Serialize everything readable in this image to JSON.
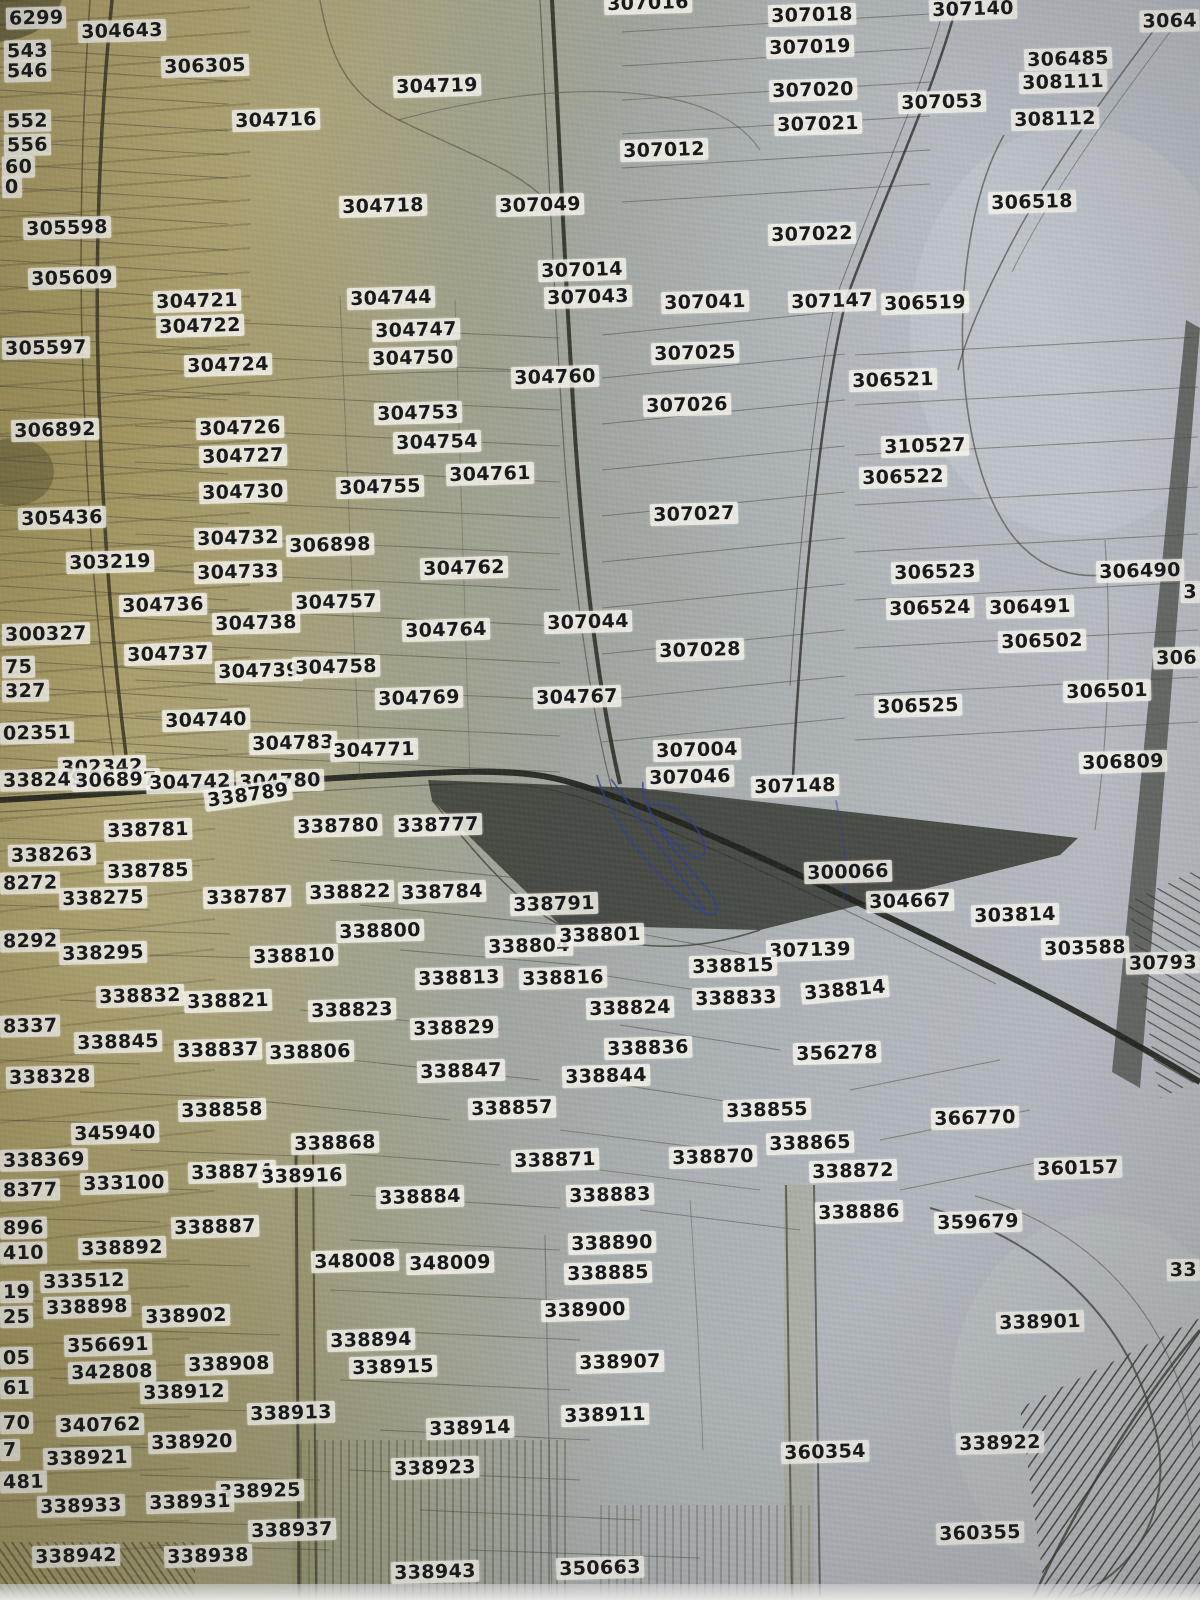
{
  "title": "cadastral-parcel-map-photo",
  "palette": {
    "map_tan": "#b0a471",
    "map_gray": "#b7bcc2",
    "label_bg": "#f4f1e8",
    "label_text": "#17181a",
    "dark_parcel": "#41453d",
    "road_dark": "#1f221c",
    "ink_blue": "#2f3f9a"
  },
  "parcels": [
    {
      "t": "6299",
      "x": 6,
      "y": 18,
      "a": "l"
    },
    {
      "t": "304643",
      "x": 122,
      "y": 31
    },
    {
      "t": "307016",
      "x": 648,
      "y": 3
    },
    {
      "t": "307018",
      "x": 812,
      "y": 15
    },
    {
      "t": "307140",
      "x": 973,
      "y": 9
    },
    {
      "t": "3064",
      "x": 1200,
      "y": 21,
      "a": "r"
    },
    {
      "t": "543",
      "x": 4,
      "y": 51,
      "a": "l"
    },
    {
      "t": "546",
      "x": 4,
      "y": 71,
      "a": "l"
    },
    {
      "t": "306305",
      "x": 205,
      "y": 66
    },
    {
      "t": "304719",
      "x": 437,
      "y": 86
    },
    {
      "t": "307019",
      "x": 810,
      "y": 47
    },
    {
      "t": "306485",
      "x": 1068,
      "y": 59
    },
    {
      "t": "308111",
      "x": 1063,
      "y": 82
    },
    {
      "t": "304716",
      "x": 276,
      "y": 120
    },
    {
      "t": "307020",
      "x": 813,
      "y": 90
    },
    {
      "t": "307053",
      "x": 942,
      "y": 102
    },
    {
      "t": "308112",
      "x": 1055,
      "y": 119
    },
    {
      "t": "307021",
      "x": 818,
      "y": 124
    },
    {
      "t": "552",
      "x": 4,
      "y": 121,
      "a": "l"
    },
    {
      "t": "556",
      "x": 4,
      "y": 145,
      "a": "l"
    },
    {
      "t": "307012",
      "x": 664,
      "y": 150
    },
    {
      "t": "60",
      "x": 2,
      "y": 167,
      "a": "l"
    },
    {
      "t": "0",
      "x": 2,
      "y": 187,
      "a": "l"
    },
    {
      "t": "304718",
      "x": 383,
      "y": 206
    },
    {
      "t": "307049",
      "x": 540,
      "y": 205
    },
    {
      "t": "306518",
      "x": 1032,
      "y": 202
    },
    {
      "t": "305598",
      "x": 67,
      "y": 228
    },
    {
      "t": "307022",
      "x": 812,
      "y": 234
    },
    {
      "t": "305609",
      "x": 72,
      "y": 278
    },
    {
      "t": "307014",
      "x": 582,
      "y": 270
    },
    {
      "t": "307043",
      "x": 588,
      "y": 297
    },
    {
      "t": "304721",
      "x": 197,
      "y": 301
    },
    {
      "t": "304744",
      "x": 391,
      "y": 298
    },
    {
      "t": "307041",
      "x": 705,
      "y": 302
    },
    {
      "t": "307147",
      "x": 832,
      "y": 301
    },
    {
      "t": "306519",
      "x": 925,
      "y": 303
    },
    {
      "t": "304722",
      "x": 200,
      "y": 326
    },
    {
      "t": "304747",
      "x": 416,
      "y": 330
    },
    {
      "t": "305597",
      "x": 2,
      "y": 348,
      "a": "l"
    },
    {
      "t": "307025",
      "x": 695,
      "y": 353
    },
    {
      "t": "304724",
      "x": 228,
      "y": 365
    },
    {
      "t": "304750",
      "x": 413,
      "y": 358
    },
    {
      "t": "306521",
      "x": 893,
      "y": 380
    },
    {
      "t": "304760",
      "x": 555,
      "y": 377
    },
    {
      "t": "307026",
      "x": 687,
      "y": 405
    },
    {
      "t": "304753",
      "x": 418,
      "y": 413
    },
    {
      "t": "306892",
      "x": 55,
      "y": 430
    },
    {
      "t": "304726",
      "x": 240,
      "y": 428
    },
    {
      "t": "310527",
      "x": 925,
      "y": 446
    },
    {
      "t": "304727",
      "x": 243,
      "y": 456
    },
    {
      "t": "304754",
      "x": 437,
      "y": 442
    },
    {
      "t": "306522",
      "x": 903,
      "y": 477
    },
    {
      "t": "304761",
      "x": 490,
      "y": 474
    },
    {
      "t": "304730",
      "x": 243,
      "y": 492
    },
    {
      "t": "304755",
      "x": 380,
      "y": 487
    },
    {
      "t": "307027",
      "x": 694,
      "y": 514
    },
    {
      "t": "305436",
      "x": 62,
      "y": 518
    },
    {
      "t": "304732",
      "x": 238,
      "y": 538
    },
    {
      "t": "306898",
      "x": 330,
      "y": 545
    },
    {
      "t": "303219",
      "x": 110,
      "y": 562
    },
    {
      "t": "304762",
      "x": 464,
      "y": 568
    },
    {
      "t": "306523",
      "x": 935,
      "y": 572
    },
    {
      "t": "306490",
      "x": 1140,
      "y": 571
    },
    {
      "t": "304733",
      "x": 238,
      "y": 572
    },
    {
      "t": "3",
      "x": 1200,
      "y": 592,
      "a": "r"
    },
    {
      "t": "306524",
      "x": 930,
      "y": 608
    },
    {
      "t": "306491",
      "x": 1030,
      "y": 607
    },
    {
      "t": "304736",
      "x": 163,
      "y": 605
    },
    {
      "t": "304757",
      "x": 336,
      "y": 602
    },
    {
      "t": "307044",
      "x": 588,
      "y": 622
    },
    {
      "t": "306502",
      "x": 1042,
      "y": 641
    },
    {
      "t": "300327",
      "x": 2,
      "y": 634,
      "a": "l"
    },
    {
      "t": "304738",
      "x": 256,
      "y": 623
    },
    {
      "t": "304764",
      "x": 446,
      "y": 630
    },
    {
      "t": "307028",
      "x": 700,
      "y": 650
    },
    {
      "t": "306",
      "x": 1200,
      "y": 658,
      "a": "r"
    },
    {
      "t": "306501",
      "x": 1107,
      "y": 691
    },
    {
      "t": "304737",
      "x": 168,
      "y": 654
    },
    {
      "t": "304739",
      "x": 259,
      "y": 671
    },
    {
      "t": "304758",
      "x": 336,
      "y": 667
    },
    {
      "t": "75",
      "x": 2,
      "y": 667,
      "a": "l"
    },
    {
      "t": "327",
      "x": 2,
      "y": 691,
      "a": "l"
    },
    {
      "t": "304740",
      "x": 206,
      "y": 720
    },
    {
      "t": "304769",
      "x": 419,
      "y": 698
    },
    {
      "t": "304767",
      "x": 577,
      "y": 697
    },
    {
      "t": "306525",
      "x": 918,
      "y": 706
    },
    {
      "t": "02351",
      "x": 0,
      "y": 733,
      "a": "l"
    },
    {
      "t": "302342",
      "x": 102,
      "y": 767
    },
    {
      "t": "304783",
      "x": 293,
      "y": 743
    },
    {
      "t": "304771",
      "x": 374,
      "y": 750
    },
    {
      "t": "307004",
      "x": 697,
      "y": 750
    },
    {
      "t": "306809",
      "x": 1123,
      "y": 762
    },
    {
      "t": "338249",
      "x": 0,
      "y": 780,
      "a": "l"
    },
    {
      "t": "306897",
      "x": 116,
      "y": 780
    },
    {
      "t": "304742",
      "x": 190,
      "y": 782
    },
    {
      "t": "304780",
      "x": 280,
      "y": 781
    },
    {
      "t": "307046",
      "x": 690,
      "y": 777
    },
    {
      "t": "307148",
      "x": 795,
      "y": 786
    },
    {
      "t": "338789",
      "x": 248,
      "y": 795,
      "r": -8
    },
    {
      "t": "338781",
      "x": 148,
      "y": 830
    },
    {
      "t": "338780",
      "x": 338,
      "y": 826
    },
    {
      "t": "338777",
      "x": 438,
      "y": 825
    },
    {
      "t": "300066",
      "x": 848,
      "y": 872
    },
    {
      "t": "338263",
      "x": 8,
      "y": 855,
      "a": "l"
    },
    {
      "t": "338785",
      "x": 148,
      "y": 871
    },
    {
      "t": "338787",
      "x": 247,
      "y": 897
    },
    {
      "t": "338822",
      "x": 350,
      "y": 892
    },
    {
      "t": "338784",
      "x": 442,
      "y": 892
    },
    {
      "t": "338791",
      "x": 554,
      "y": 904
    },
    {
      "t": "304667",
      "x": 910,
      "y": 901
    },
    {
      "t": "8272",
      "x": 0,
      "y": 883,
      "a": "l"
    },
    {
      "t": "338275",
      "x": 103,
      "y": 898
    },
    {
      "t": "338800",
      "x": 380,
      "y": 931
    },
    {
      "t": "338804",
      "x": 529,
      "y": 946
    },
    {
      "t": "338801",
      "x": 600,
      "y": 935
    },
    {
      "t": "303814",
      "x": 1015,
      "y": 915
    },
    {
      "t": "8292",
      "x": 0,
      "y": 941,
      "a": "l"
    },
    {
      "t": "338295",
      "x": 103,
      "y": 953
    },
    {
      "t": "338810",
      "x": 294,
      "y": 956
    },
    {
      "t": "303588",
      "x": 1085,
      "y": 948
    },
    {
      "t": "30793",
      "x": 1200,
      "y": 963,
      "a": "r"
    },
    {
      "t": "338813",
      "x": 459,
      "y": 978
    },
    {
      "t": "338816",
      "x": 563,
      "y": 978
    },
    {
      "t": "307139",
      "x": 810,
      "y": 950
    },
    {
      "t": "338815",
      "x": 733,
      "y": 966
    },
    {
      "t": "338814",
      "x": 845,
      "y": 990,
      "r": -5
    },
    {
      "t": "338821",
      "x": 228,
      "y": 1001
    },
    {
      "t": "338823",
      "x": 352,
      "y": 1010
    },
    {
      "t": "338824",
      "x": 630,
      "y": 1008
    },
    {
      "t": "338833",
      "x": 736,
      "y": 998
    },
    {
      "t": "338832",
      "x": 140,
      "y": 996
    },
    {
      "t": "338829",
      "x": 454,
      "y": 1028
    },
    {
      "t": "8337",
      "x": 0,
      "y": 1026,
      "a": "l"
    },
    {
      "t": "338837",
      "x": 218,
      "y": 1050
    },
    {
      "t": "338806",
      "x": 310,
      "y": 1052
    },
    {
      "t": "338845",
      "x": 118,
      "y": 1042
    },
    {
      "t": "338847",
      "x": 461,
      "y": 1071
    },
    {
      "t": "338836",
      "x": 648,
      "y": 1048
    },
    {
      "t": "356278",
      "x": 837,
      "y": 1053
    },
    {
      "t": "338328",
      "x": 6,
      "y": 1077,
      "a": "l"
    },
    {
      "t": "338844",
      "x": 606,
      "y": 1076
    },
    {
      "t": "338858",
      "x": 222,
      "y": 1110
    },
    {
      "t": "338857",
      "x": 512,
      "y": 1108
    },
    {
      "t": "338855",
      "x": 767,
      "y": 1110
    },
    {
      "t": "345940",
      "x": 115,
      "y": 1133
    },
    {
      "t": "338868",
      "x": 335,
      "y": 1143
    },
    {
      "t": "366770",
      "x": 975,
      "y": 1118
    },
    {
      "t": "338865",
      "x": 810,
      "y": 1143
    },
    {
      "t": "338369",
      "x": 0,
      "y": 1160,
      "a": "l"
    },
    {
      "t": "338874",
      "x": 232,
      "y": 1172
    },
    {
      "t": "338871",
      "x": 555,
      "y": 1160
    },
    {
      "t": "338870",
      "x": 713,
      "y": 1157
    },
    {
      "t": "338872",
      "x": 853,
      "y": 1171
    },
    {
      "t": "333100",
      "x": 124,
      "y": 1183
    },
    {
      "t": "338916",
      "x": 302,
      "y": 1176
    },
    {
      "t": "360157",
      "x": 1078,
      "y": 1168
    },
    {
      "t": "8377",
      "x": 0,
      "y": 1190,
      "a": "l"
    },
    {
      "t": "338884",
      "x": 420,
      "y": 1197
    },
    {
      "t": "338883",
      "x": 610,
      "y": 1195
    },
    {
      "t": "338886",
      "x": 859,
      "y": 1212
    },
    {
      "t": "896",
      "x": 0,
      "y": 1228,
      "a": "l"
    },
    {
      "t": "338887",
      "x": 215,
      "y": 1227
    },
    {
      "t": "359679",
      "x": 978,
      "y": 1222
    },
    {
      "t": "410",
      "x": 0,
      "y": 1253,
      "a": "l"
    },
    {
      "t": "338892",
      "x": 122,
      "y": 1248
    },
    {
      "t": "348008",
      "x": 355,
      "y": 1261
    },
    {
      "t": "348009",
      "x": 450,
      "y": 1263
    },
    {
      "t": "338890",
      "x": 612,
      "y": 1243
    },
    {
      "t": "33",
      "x": 1200,
      "y": 1270,
      "a": "r"
    },
    {
      "t": "333512",
      "x": 84,
      "y": 1281
    },
    {
      "t": "19",
      "x": 0,
      "y": 1292,
      "a": "l"
    },
    {
      "t": "338898",
      "x": 87,
      "y": 1307
    },
    {
      "t": "25",
      "x": 0,
      "y": 1317,
      "a": "l"
    },
    {
      "t": "338902",
      "x": 186,
      "y": 1316
    },
    {
      "t": "338885",
      "x": 608,
      "y": 1273
    },
    {
      "t": "338900",
      "x": 585,
      "y": 1310
    },
    {
      "t": "338901",
      "x": 1040,
      "y": 1322
    },
    {
      "t": "356691",
      "x": 108,
      "y": 1345
    },
    {
      "t": "338894",
      "x": 371,
      "y": 1340
    },
    {
      "t": "05",
      "x": 0,
      "y": 1358,
      "a": "l"
    },
    {
      "t": "342808",
      "x": 112,
      "y": 1372
    },
    {
      "t": "338908",
      "x": 229,
      "y": 1364
    },
    {
      "t": "338915",
      "x": 393,
      "y": 1367
    },
    {
      "t": "338907",
      "x": 620,
      "y": 1362
    },
    {
      "t": "61",
      "x": 0,
      "y": 1388,
      "a": "l"
    },
    {
      "t": "338912",
      "x": 184,
      "y": 1392
    },
    {
      "t": "338913",
      "x": 291,
      "y": 1413
    },
    {
      "t": "338911",
      "x": 605,
      "y": 1415
    },
    {
      "t": "70",
      "x": 0,
      "y": 1423,
      "a": "l"
    },
    {
      "t": "340762",
      "x": 100,
      "y": 1425
    },
    {
      "t": "338914",
      "x": 470,
      "y": 1428
    },
    {
      "t": "338920",
      "x": 192,
      "y": 1442
    },
    {
      "t": "7",
      "x": 0,
      "y": 1450,
      "a": "l"
    },
    {
      "t": "338921",
      "x": 87,
      "y": 1458
    },
    {
      "t": "338923",
      "x": 435,
      "y": 1468
    },
    {
      "t": "360354",
      "x": 825,
      "y": 1452
    },
    {
      "t": "338922",
      "x": 1000,
      "y": 1443
    },
    {
      "t": "481",
      "x": 0,
      "y": 1482,
      "a": "l"
    },
    {
      "t": "338925",
      "x": 260,
      "y": 1491
    },
    {
      "t": "338933",
      "x": 81,
      "y": 1506
    },
    {
      "t": "338931",
      "x": 190,
      "y": 1502
    },
    {
      "t": "338937",
      "x": 292,
      "y": 1530
    },
    {
      "t": "360355",
      "x": 980,
      "y": 1533
    },
    {
      "t": "338942",
      "x": 76,
      "y": 1556
    },
    {
      "t": "338938",
      "x": 208,
      "y": 1556
    },
    {
      "t": "338943",
      "x": 435,
      "y": 1572
    },
    {
      "t": "350663",
      "x": 600,
      "y": 1568
    }
  ]
}
